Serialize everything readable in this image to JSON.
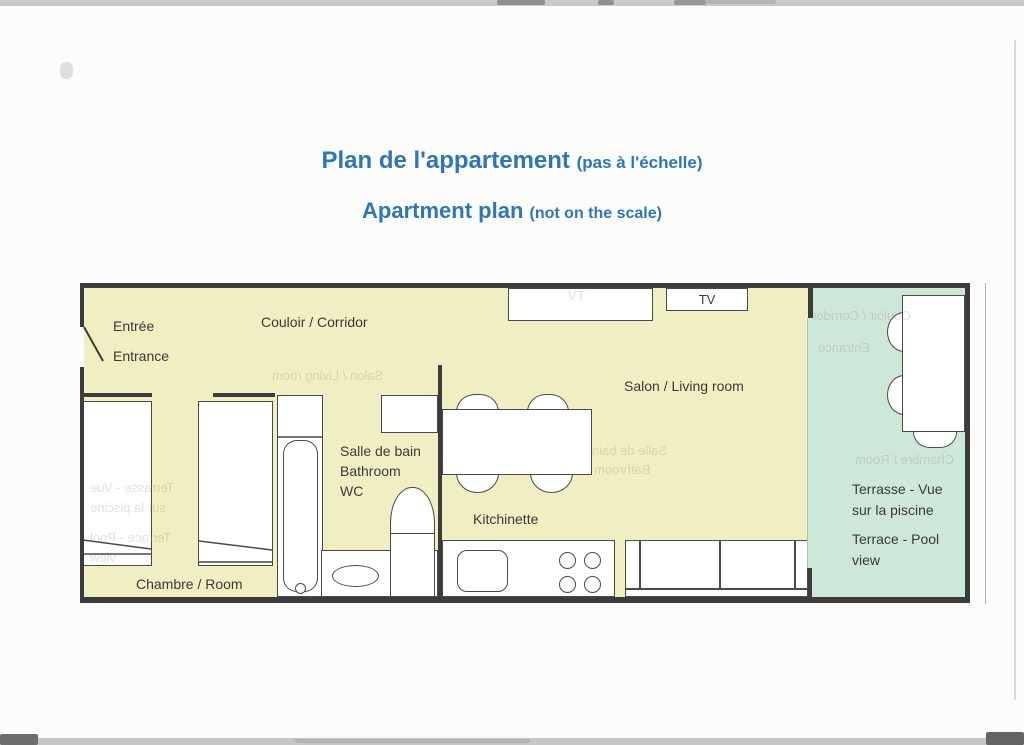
{
  "document": {
    "title_fr_main": "Plan de l'appartement",
    "title_fr_note": "(pas à l'échelle)",
    "title_en_main": "Apartment plan",
    "title_en_note": "(not on the scale)",
    "title_color": "#2F76B8"
  },
  "plan": {
    "colors": {
      "interior": "#F0EFC3",
      "terrace": "#CDE7D8",
      "wall": "#3C3C3C",
      "furniture_line": "#4A4A48"
    },
    "rooms": {
      "entrance_fr": "Entrée",
      "entrance_en": "Entrance",
      "corridor": "Couloir / Corridor",
      "living": "Salon / Living room",
      "bathroom_fr": "Salle de bain",
      "bathroom_en": "Bathroom",
      "wc": "WC",
      "kitchen": "Kitchinette",
      "bedroom": "Chambre / Room",
      "terrace_fr_1": "Terrasse - Vue",
      "terrace_fr_2": "sur la piscine",
      "terrace_en_1": "Terrace - Pool",
      "terrace_en_2": "view"
    },
    "furniture": {
      "tv": "TV"
    }
  },
  "bleed_through": {
    "tv": "TV",
    "salon": "Salon / Living room",
    "corridor": "Couloir / Corridor",
    "entrance": "Entrance",
    "bath_1": "Salle de bain",
    "bath_2": "Bathroom",
    "bedroom": "Chambre / Room",
    "terrace_1": "Terrasse - Vue",
    "terrace_2": "sur la piscine",
    "terrace_3": "Terrace - Pool",
    "terrace_4": "view"
  }
}
